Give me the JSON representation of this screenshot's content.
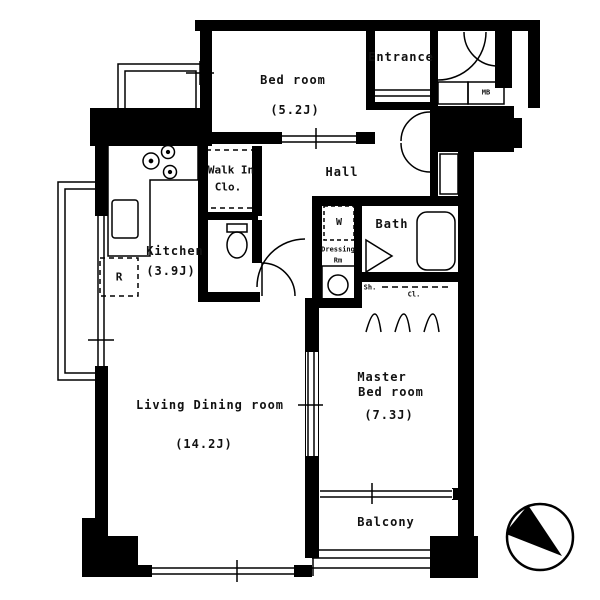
{
  "title": "Apartment floor plan",
  "rooms": {
    "bedroom": {
      "label": "Bed room",
      "size": "(5.2J)"
    },
    "entrance": {
      "label": "Entrance"
    },
    "wic": {
      "line1": "Walk In",
      "line2": "Clo."
    },
    "hall": {
      "label": "Hall"
    },
    "kitchen": {
      "label": "Kitchen",
      "size": "(3.9J)"
    },
    "bath": {
      "label": "Bath"
    },
    "living": {
      "label": "Living Dining room",
      "size": "(14.2J)"
    },
    "master": {
      "line1": "Master",
      "line2": "Bed room",
      "size": "(7.3J)"
    },
    "balcony": {
      "label": "Balcony"
    }
  },
  "fixtures": {
    "meter_box": "MB",
    "washing_machine": "W",
    "dressing_line1": "Dressing",
    "dressing_line2": "Rm",
    "refrigerator": "R",
    "shelf": "Sh.",
    "closet": "Cl."
  },
  "colors": {
    "wall": "#000000",
    "background": "#ffffff",
    "line": "#111111"
  }
}
